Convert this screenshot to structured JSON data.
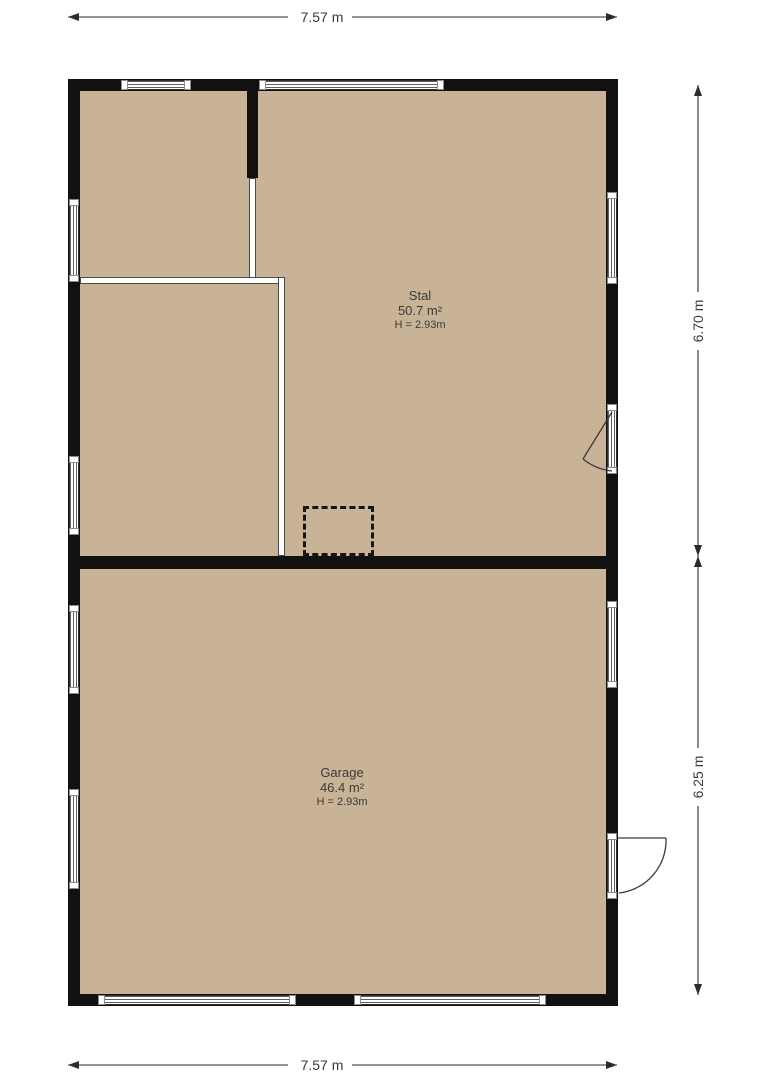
{
  "plan_type": "floorplan",
  "rooms": [
    {
      "name": "Stal",
      "area": "50.7 m²",
      "height": "H = 2.93m"
    },
    {
      "name": "Garage",
      "area": "46.4 m²",
      "height": "H = 2.93m"
    }
  ],
  "dimensions": {
    "top": "7.57 m",
    "bottom": "7.57 m",
    "right_upper": "6.70 m",
    "right_lower": "6.25 m"
  },
  "colors": {
    "floor": "#c9b397",
    "wall": "#111111",
    "window_stripe": "#5f5f5f",
    "text": "#3a3a3a",
    "background": "#ffffff"
  }
}
